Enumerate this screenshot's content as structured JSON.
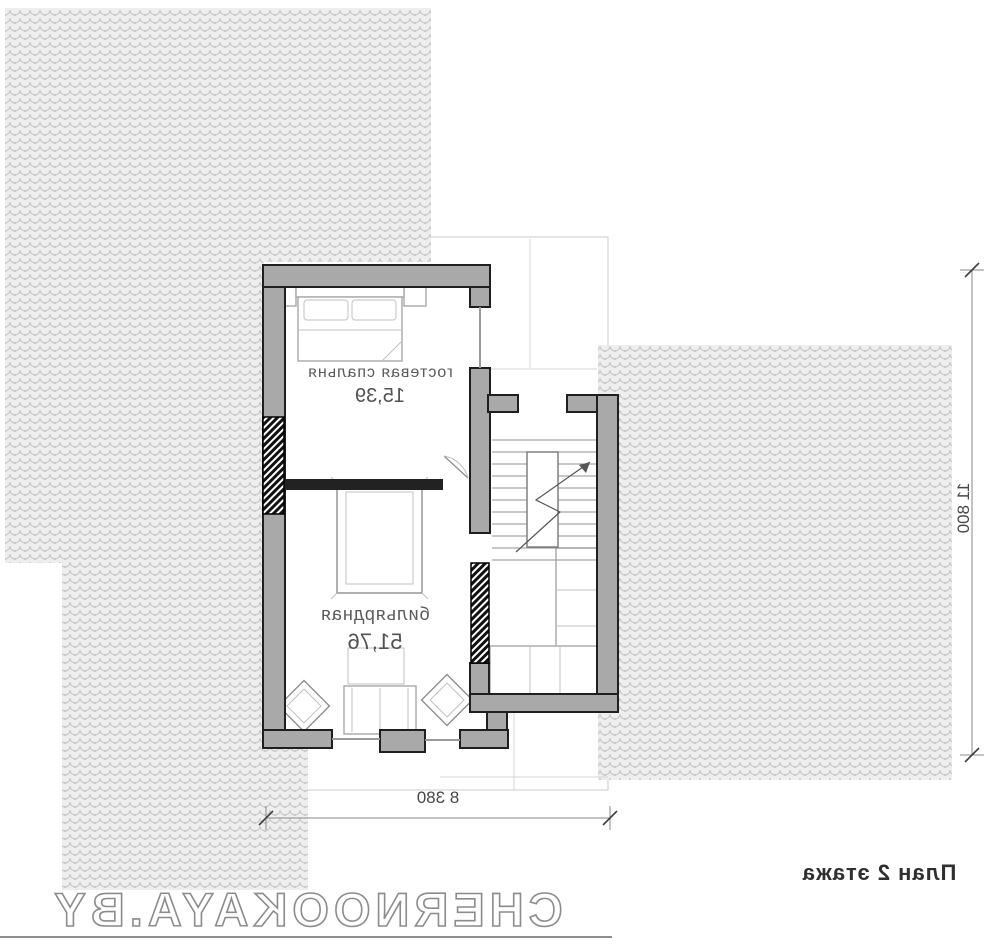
{
  "plan": {
    "title": "План 2 этажа",
    "watermark": "CHERNOOKAYA.BY",
    "rooms": [
      {
        "name": "гостевая спальня",
        "area": "15,39"
      },
      {
        "name": "бильярдная",
        "area": "51,76"
      }
    ],
    "dimensions": {
      "width": "8 380",
      "height": "11 800"
    },
    "colors": {
      "wall_fill": "#a9a9a9",
      "wall_outline": "#1f1f1f",
      "roof_hatch_bg": "#eeeeee",
      "roof_hatch_line": "#c6c6c6",
      "dimension_line": "#8a8a8a",
      "label_text": "#5a5a5a",
      "watermark_stroke": "#8c8c8c"
    },
    "icons": {
      "bed": "bed-icon",
      "billiard_table": "billiard-table-icon",
      "sofa": "sofa-icon",
      "armchairs": "armchair-icon",
      "corner_sofa": "corner-sofa-icon",
      "staircase": "staircase-icon",
      "shafts": "chimney-shaft-icon"
    }
  }
}
